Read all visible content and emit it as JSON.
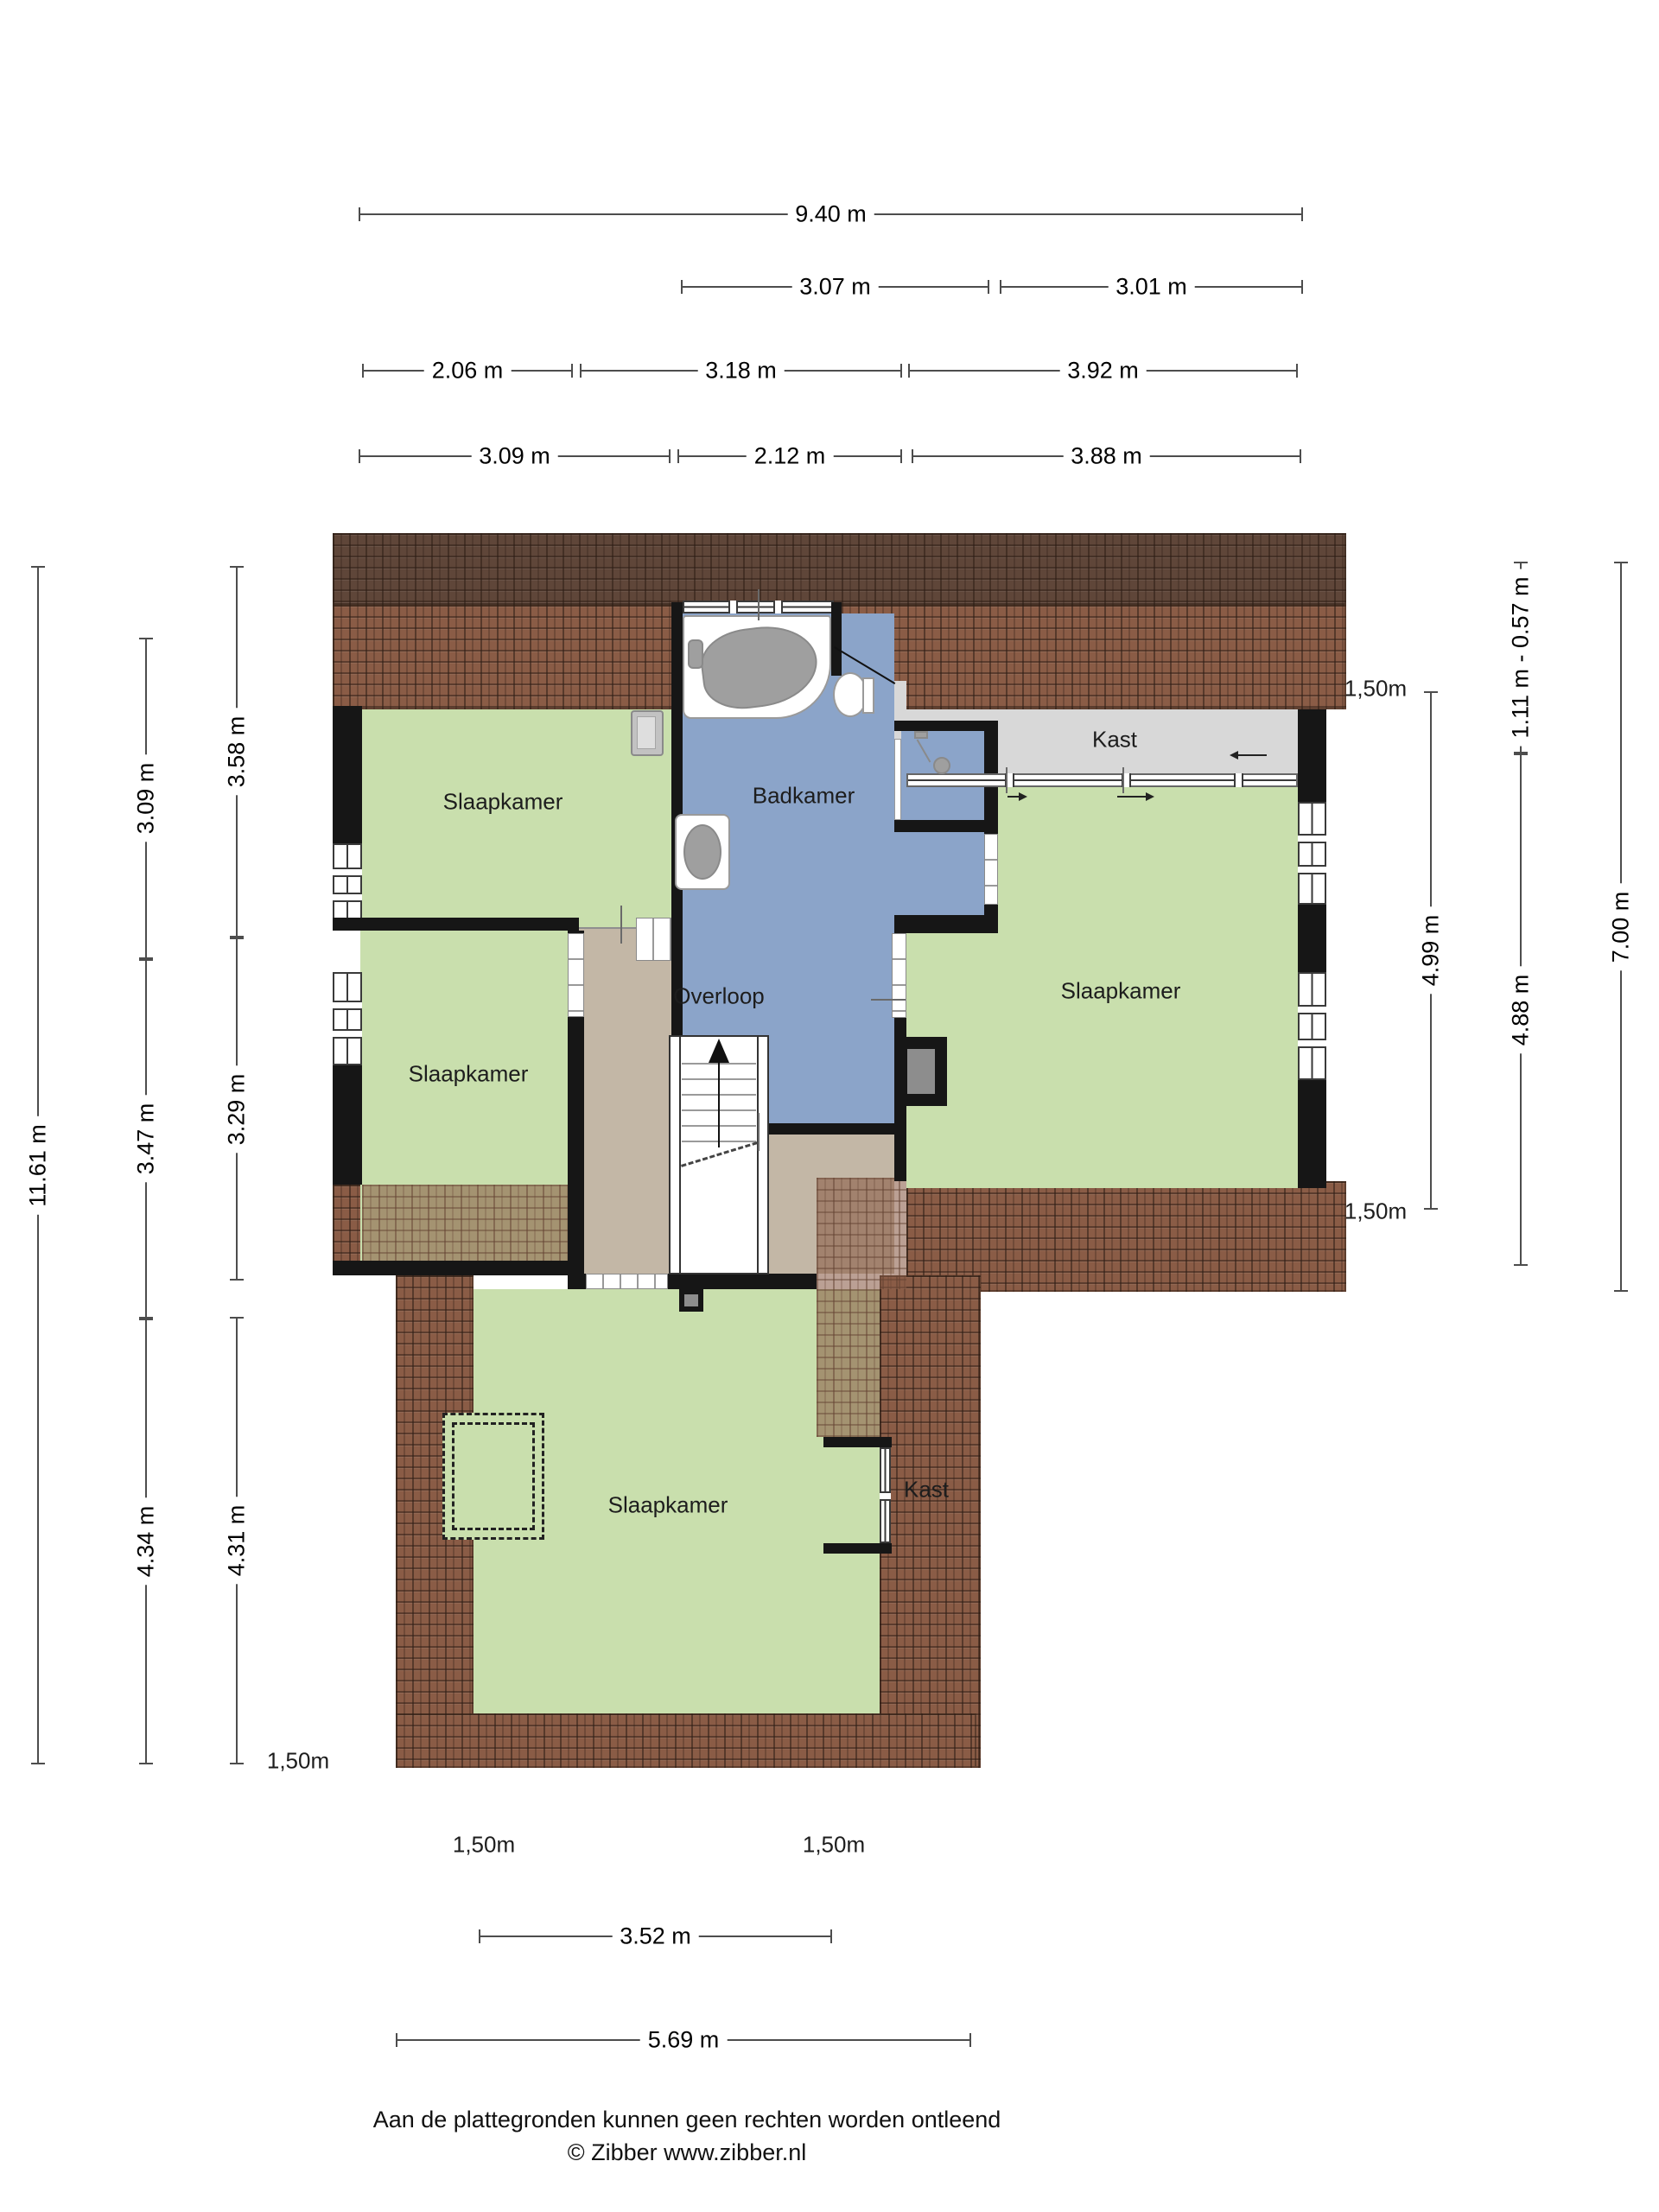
{
  "rooms": {
    "bedroom_top_left": "Slaapkamer",
    "bedroom_mid_left": "Slaapkamer",
    "bedroom_right": "Slaapkamer",
    "bedroom_bottom": "Slaapkamer",
    "bathroom": "Badkamer",
    "landing": "Overloop",
    "closet_top": "Kast",
    "closet_bottom": "Kast"
  },
  "dims": {
    "h1": [
      "9.40 m"
    ],
    "h2": [
      "3.07 m",
      "3.01 m"
    ],
    "h3": [
      "2.06 m",
      "3.18 m",
      "3.92 m"
    ],
    "h4": [
      "3.09 m",
      "2.12 m",
      "3.88 m"
    ],
    "left_total": "11.61 m",
    "left_mid": [
      "3.09 m",
      "3.47 m",
      "4.34 m"
    ],
    "left_inner": [
      "3.58 m",
      "3.29 m",
      "4.31 m"
    ],
    "right_inner_top": "1,50m",
    "right_inner_line": "4.99 m",
    "right_inner_bottom": "1,50m",
    "right_mid": [
      "1.11 m - 0.57 m",
      "4.88 m"
    ],
    "right_total": "7.00 m",
    "low_left_marker": "1,50m",
    "bottom_markers": [
      "1,50m",
      "1,50m"
    ],
    "bottom_width_inner": "3.52 m",
    "bottom_width_total": "5.69 m"
  },
  "footer": {
    "disclaimer": "Aan de plattegronden kunnen geen rechten worden ontleend",
    "credit": "© Zibber www.zibber.nl"
  },
  "colors": {
    "room_green": "#c9dfad",
    "bathroom_blue": "#8ba4c9",
    "landing_tan": "#c3b7a6",
    "closet_gray": "#d8d8d8",
    "wall_black": "#161616",
    "roof_brown": "#8a5c46",
    "roof_dark": "#5f4639"
  }
}
